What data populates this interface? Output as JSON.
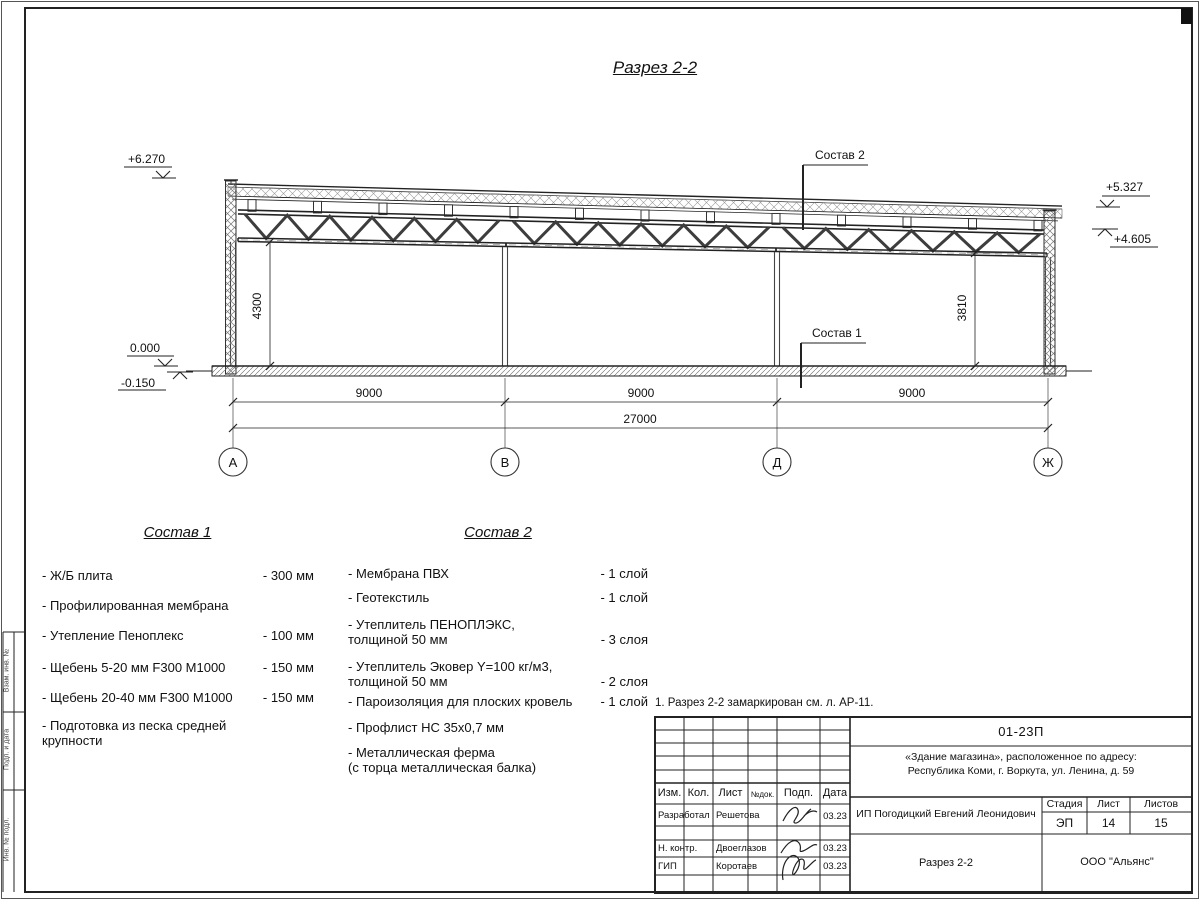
{
  "page": {
    "title": "Разрез 2-2",
    "note": "1. Разрез 2-2 замаркирован см. л. АР-11."
  },
  "section": {
    "elevations": {
      "roof_left": "+6.270",
      "roof_right_top": "+5.327",
      "roof_right_bottom": "+4.605",
      "floor": "0.000",
      "ground": "-0.150"
    },
    "heights": {
      "left": "4300",
      "right": "3810"
    },
    "spans": [
      "9000",
      "9000",
      "9000"
    ],
    "total": "27000",
    "axes": [
      "А",
      "В",
      "Д",
      "Ж"
    ],
    "callouts": {
      "top": "Состав 2",
      "bottom": "Состав 1"
    }
  },
  "composition1": {
    "title": "Состав 1",
    "items": [
      {
        "name": "- Ж/Б плита",
        "value": "- 300 мм"
      },
      {
        "name": "- Профилированная мембрана",
        "value": ""
      },
      {
        "name": "- Утепление Пеноплекс",
        "value": "- 100 мм"
      },
      {
        "name": "-  Щебень 5-20 мм F300 М1000",
        "value": "- 150 мм"
      },
      {
        "name": "-  Щебень 20-40 мм F300 М1000",
        "value": "- 150 мм"
      },
      {
        "name": "- Подготовка из песка средней\nкрупности",
        "value": ""
      }
    ]
  },
  "composition2": {
    "title": "Состав 2",
    "items": [
      {
        "name": "- Мембрана ПВХ",
        "value": "- 1 слой"
      },
      {
        "name": "- Геотекстиль",
        "value": "- 1 слой"
      },
      {
        "name": "- Утеплитель ПЕНОПЛЭКС,\nтолщиной 50 мм",
        "value": "- 3 слоя"
      },
      {
        "name": "- Утеплитель Эковер Y=100 кг/м3,\nтолщиной 50 мм",
        "value": "- 2 слоя"
      },
      {
        "name": "- Пароизоляция для плоских кровель",
        "value": "- 1 слой"
      },
      {
        "name": "- Профлист НС 35х0,7 мм",
        "value": ""
      },
      {
        "name": "- Металлическая ферма\n(с торца металлическая балка)",
        "value": ""
      }
    ]
  },
  "titleblock": {
    "doc_number": "01-23П",
    "project_line1": "«Здание магазина», расположенное по адресу:",
    "project_line2": "Республика Коми, г. Воркута, ул. Ленина, д. 59",
    "columns": [
      "Изм.",
      "Кол.",
      "Лист",
      "№док.",
      "Подп.",
      "Дата"
    ],
    "rows": [
      {
        "role": "Разработал",
        "name": "Решетова",
        "date": "03.23"
      },
      {
        "role": "Н. контр.",
        "name": "Двоеглазов",
        "date": "03.23"
      },
      {
        "role": "ГИП",
        "name": "Коротаев",
        "date": "03.23"
      }
    ],
    "client": "ИП Погодицкий Евгений Леонидович",
    "sheet_title": "Разрез 2-2",
    "stage_label": "Стадия",
    "sheet_label": "Лист",
    "sheets_label": "Листов",
    "stage": "ЭП",
    "sheet": "14",
    "sheets": "15",
    "organization": "ООО \"Альянс\""
  },
  "side_stamp": {
    "labels": [
      "Взам. инв. №",
      "Подп. и дата",
      "Инв. № подл."
    ]
  }
}
